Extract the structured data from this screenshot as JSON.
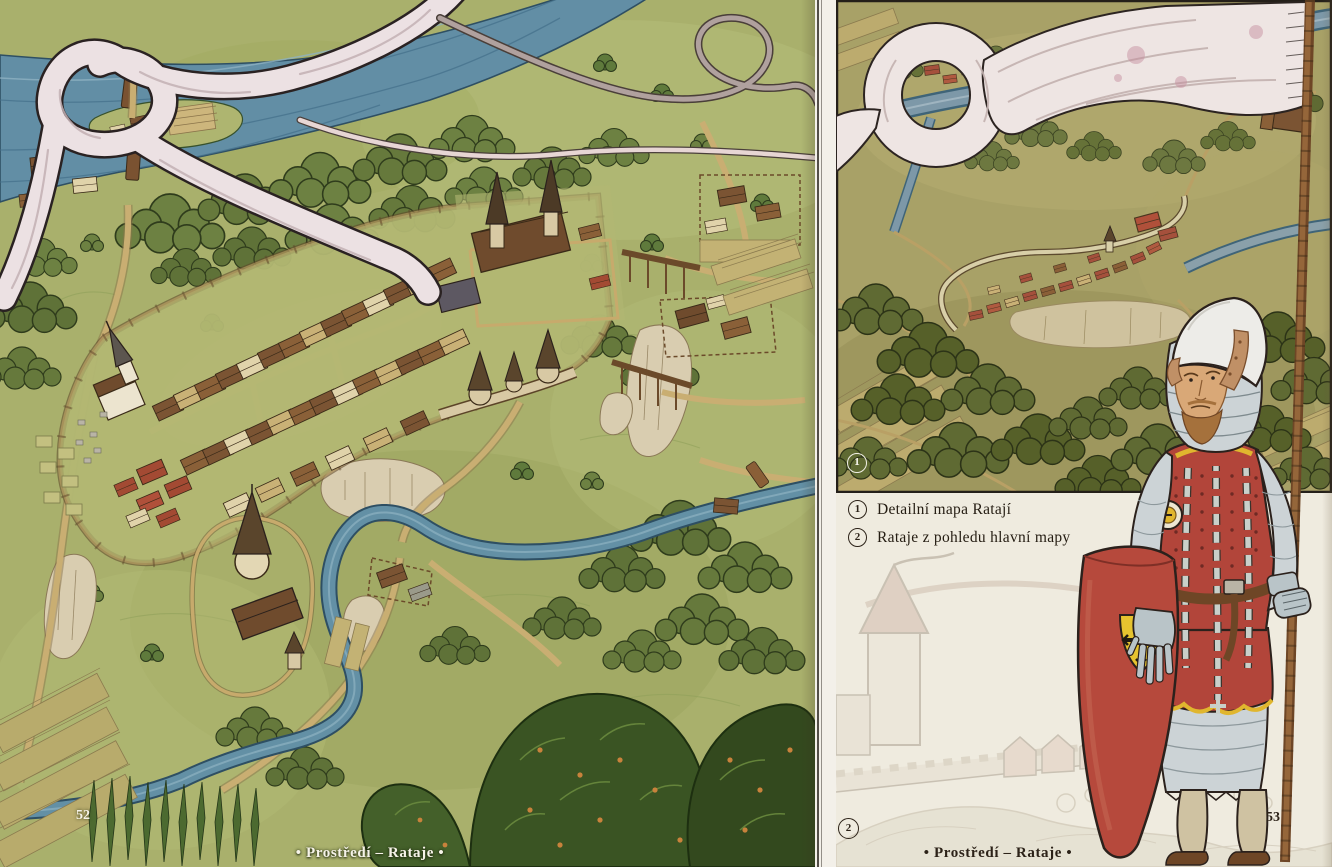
{
  "book": {
    "left_page": {
      "page_number": "52",
      "footer": "• Prostředí – Rataje •"
    },
    "right_page": {
      "page_number": "53",
      "footer": "• Prostředí – Rataje •",
      "legend": [
        {
          "marker": "1",
          "label": "Detailní mapa Ratají"
        },
        {
          "marker": "2",
          "label": "Rataje z pohledu hlavní mapy"
        }
      ],
      "markers": {
        "detail_map": "1",
        "main_map_view": "2"
      }
    }
  },
  "colors": {
    "parchment": "#efebdf",
    "map_green": "#a9b06c",
    "detail_map_olive": "#a8a167",
    "river_blue": "#6390a5",
    "banner_white": "#eee5e3",
    "knight_red": "#b2453a",
    "emblem_yellow": "#e6c32f",
    "ink": "#2c2218"
  }
}
